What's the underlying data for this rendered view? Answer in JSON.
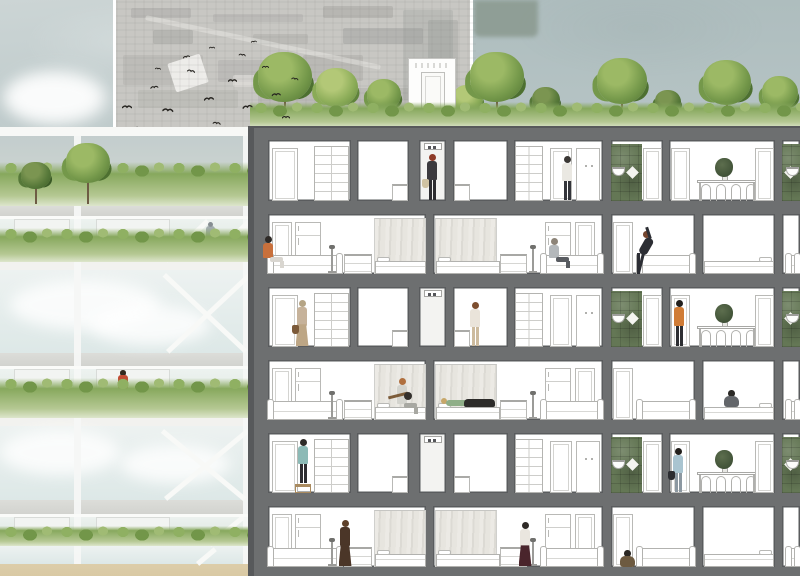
{
  "meta": {
    "type": "architectural-section-collage",
    "description": "Watercolor architectural cross-section of an apartment block with rooftop trees, aerial photo inset with bird flock, and glazed green-balcony facade at left"
  },
  "palette": {
    "sky_light": "#ccd5d5",
    "sky_base": "#b6c4c5",
    "sky_right": "#aebdbe",
    "sky_patch": "#8a998f",
    "photo_bg": "#c8c7c3",
    "photo_mark": "#8d8d8a",
    "bird": "#262420",
    "frame": "#6d6f70",
    "frame_edge": "#57595b",
    "room": "#ffffff",
    "room_line": "#5a5c5e",
    "shaft": "#f3f3f1",
    "furniture_line": "#b9b9b6",
    "tile_green": "#647755",
    "curtain": "#e7e5e0",
    "grass": "#87a85d",
    "grass_light": "#b5c893",
    "tree_light": "#8aab57",
    "tree_mid": "#74984a",
    "tree_dark": "#567839",
    "trunk": "#6e5c44",
    "glass": "#e7efee",
    "cloud": "#ffffff",
    "mullion": "#f6f7f5",
    "slab_white": "#f7f8f6",
    "slab_grey": "#d2d3cf",
    "spandrel": "#f2f2ef",
    "ground_tan": "#d9c9a4"
  },
  "sky": {
    "patch": {
      "x": 474,
      "y": 0,
      "w": 64,
      "h": 37
    }
  },
  "photo": {
    "x": 113,
    "y": 0,
    "w": 360,
    "h": 129,
    "marks": [
      {
        "x": 128,
        "y": 8,
        "w": 60,
        "h": 10,
        "o": 0.25
      },
      {
        "x": 210,
        "y": 14,
        "w": 90,
        "h": 8,
        "o": 0.2
      },
      {
        "x": 320,
        "y": 6,
        "w": 70,
        "h": 12,
        "o": 0.28
      },
      {
        "x": 150,
        "y": 30,
        "w": 40,
        "h": 14,
        "o": 0.3
      },
      {
        "x": 250,
        "y": 34,
        "w": 55,
        "h": 10,
        "o": 0.22
      },
      {
        "x": 340,
        "y": 28,
        "w": 80,
        "h": 16,
        "o": 0.35,
        "c": "#8f938f"
      },
      {
        "x": 400,
        "y": 10,
        "w": 50,
        "h": 90,
        "o": 0.3,
        "c": "#9aa09c"
      },
      {
        "x": 425,
        "y": 20,
        "w": 30,
        "h": 100,
        "o": 0.25,
        "c": "#878d89"
      },
      {
        "x": 120,
        "y": 55,
        "w": 80,
        "h": 30,
        "o": 0.18
      },
      {
        "x": 215,
        "y": 60,
        "w": 70,
        "h": 22,
        "o": 0.2
      },
      {
        "x": 300,
        "y": 55,
        "w": 60,
        "h": 26,
        "o": 0.24
      },
      {
        "x": 135,
        "y": 90,
        "w": 100,
        "h": 18,
        "o": 0.16
      },
      {
        "x": 255,
        "y": 92,
        "w": 80,
        "h": 16,
        "o": 0.2
      },
      {
        "x": 350,
        "y": 88,
        "w": 70,
        "h": 20,
        "o": 0.22
      },
      {
        "x": 140,
        "y": 40,
        "w": 240,
        "h": 5,
        "o": 0.5,
        "c": "#e8e7e3",
        "r": 12
      },
      {
        "x": 168,
        "y": 58,
        "w": 34,
        "h": 30,
        "o": 0.9,
        "c": "#f2f1ee",
        "r": -18
      },
      {
        "x": 230,
        "y": 75,
        "w": 26,
        "h": 12,
        "o": 0.5,
        "c": "#eceae6"
      }
    ]
  },
  "birds": [
    [
      122,
      96,
      10,
      0
    ],
    [
      136,
      118,
      9,
      10
    ],
    [
      149,
      76,
      8,
      -8
    ],
    [
      163,
      100,
      11,
      5
    ],
    [
      176,
      124,
      9,
      0
    ],
    [
      189,
      60,
      8,
      12
    ],
    [
      203,
      88,
      10,
      -6
    ],
    [
      214,
      112,
      8,
      8
    ],
    [
      228,
      70,
      9,
      0
    ],
    [
      241,
      96,
      10,
      -10
    ],
    [
      254,
      120,
      8,
      6
    ],
    [
      262,
      56,
      7,
      0
    ],
    [
      271,
      84,
      9,
      -5
    ],
    [
      240,
      44,
      7,
      8
    ],
    [
      209,
      36,
      6,
      0
    ],
    [
      181,
      46,
      7,
      -12
    ],
    [
      156,
      57,
      6,
      6
    ],
    [
      282,
      106,
      8,
      0
    ],
    [
      293,
      68,
      7,
      10
    ],
    [
      250,
      30,
      6,
      -5
    ]
  ],
  "roof": {
    "grass": {
      "x": 250,
      "y": 100,
      "w": 550,
      "h": 28
    },
    "trees": [
      {
        "cx": 285,
        "r": 27,
        "tone": "mid"
      },
      {
        "cx": 337,
        "r": 21,
        "tone": "light"
      },
      {
        "cx": 384,
        "r": 17,
        "tone": "mid"
      },
      {
        "cx": 468,
        "r": 15,
        "tone": "light"
      },
      {
        "cx": 497,
        "r": 27,
        "tone": "mid"
      },
      {
        "cx": 546,
        "r": 14,
        "tone": "dark"
      },
      {
        "cx": 622,
        "r": 25,
        "tone": "mid"
      },
      {
        "cx": 668,
        "r": 13,
        "tone": "dark"
      },
      {
        "cx": 727,
        "r": 24,
        "tone": "mid"
      },
      {
        "cx": 780,
        "r": 18,
        "tone": "mid"
      }
    ],
    "penthouse": {
      "x": 408,
      "y": 58,
      "w": 48,
      "h": 69,
      "door": {
        "x": 12,
        "y": 13,
        "w": 24,
        "h": 55
      }
    }
  },
  "section": {
    "base": {
      "x": 248,
      "y": 126,
      "w": 552,
      "h": 450
    },
    "floors": [
      {
        "layout": "odd",
        "top": 140,
        "bottom": 201
      },
      {
        "layout": "even",
        "top": 214,
        "bottom": 274
      },
      {
        "layout": "odd",
        "top": 287,
        "bottom": 347
      },
      {
        "layout": "even",
        "top": 360,
        "bottom": 420
      },
      {
        "layout": "odd",
        "top": 433,
        "bottom": 493
      },
      {
        "layout": "even",
        "top": 506,
        "bottom": 567
      }
    ],
    "layouts": {
      "odd": {
        "shaft": 2,
        "rooms": [
          [
            268,
            351
          ],
          [
            357,
            409
          ],
          [
            419,
            446
          ],
          [
            453,
            508
          ],
          [
            514,
            603
          ],
          [
            611,
            663
          ],
          [
            669,
            775
          ],
          [
            782,
            800
          ]
        ],
        "items": [
          {
            "t": "door",
            "x": 272,
            "w": 26
          },
          {
            "t": "wardrobe",
            "x": 314,
            "w": 35
          },
          {
            "t": "counter2",
            "x": 392,
            "w": 16
          },
          {
            "t": "indicator",
            "x": 424,
            "w": 18
          },
          {
            "t": "counter2",
            "x": 454,
            "w": 16
          },
          {
            "t": "wardrobe",
            "x": 515,
            "w": 28
          },
          {
            "t": "door",
            "x": 550,
            "w": 22
          },
          {
            "t": "cabinet",
            "x": 576,
            "w": 24
          },
          {
            "t": "tile",
            "x": 611,
            "w": 31
          },
          {
            "t": "sink",
            "x": 611,
            "w": 16,
            "side": "l"
          },
          {
            "t": "door",
            "x": 643,
            "w": 19
          },
          {
            "t": "door",
            "x": 671,
            "w": 19
          },
          {
            "t": "table",
            "x": 697,
            "w": 60
          },
          {
            "t": "plant",
            "x": 717,
            "w": 15
          },
          {
            "t": "door",
            "x": 755,
            "w": 19
          },
          {
            "t": "tile",
            "x": 782,
            "w": 18
          },
          {
            "t": "sink",
            "x": 786,
            "w": 14,
            "side": "r"
          }
        ]
      },
      "even": {
        "rooms": [
          [
            268,
            426
          ],
          [
            433,
            603
          ],
          [
            611,
            695
          ],
          [
            702,
            775
          ],
          [
            782,
            800
          ]
        ],
        "items": [
          {
            "t": "door",
            "x": 272,
            "w": 20
          },
          {
            "t": "fridge",
            "x": 295,
            "w": 26
          },
          {
            "t": "sofa",
            "x": 268,
            "w": 74
          },
          {
            "t": "lamp",
            "x": 331
          },
          {
            "t": "counter",
            "x": 344,
            "w": 28
          },
          {
            "t": "curtain",
            "x": 374,
            "w": 52
          },
          {
            "t": "bed",
            "x": 375,
            "w": 51,
            "pil": "l"
          },
          {
            "t": "curtain",
            "x": 435,
            "w": 62
          },
          {
            "t": "bed",
            "x": 436,
            "w": 64,
            "pil": "l"
          },
          {
            "t": "counter",
            "x": 500,
            "w": 27
          },
          {
            "t": "lamp",
            "x": 532
          },
          {
            "t": "fridge",
            "x": 545,
            "w": 26
          },
          {
            "t": "door",
            "x": 575,
            "w": 20
          },
          {
            "t": "sofa",
            "x": 541,
            "w": 62
          },
          {
            "t": "door",
            "x": 613,
            "w": 20
          },
          {
            "t": "sofa",
            "x": 637,
            "w": 58
          },
          {
            "t": "bed",
            "x": 704,
            "w": 70,
            "pil": "r"
          },
          {
            "t": "sofa",
            "x": 786,
            "w": 14
          }
        ]
      }
    },
    "people": {
      "0": [
        {
          "pose": "stand",
          "x": 423,
          "h": 47,
          "hair": "#8e3b28",
          "top": "#3b3a3e",
          "bottom": "#2c2c30",
          "bag": "#cfc2a2"
        },
        {
          "pose": "stand",
          "x": 558,
          "h": 45,
          "hair": "#3b3835",
          "top": "#eae8e2",
          "bottom": "#34353b"
        }
      ],
      "1": [
        {
          "pose": "sit",
          "x": 262,
          "h": 32,
          "dy": -6,
          "hair": "#2e2a27",
          "top": "#c8703c",
          "bottom": "#d9d6d0"
        },
        {
          "pose": "sit",
          "x": 548,
          "h": 30,
          "dy": -6,
          "hair": "#8d8478",
          "top": "#b4b8bb",
          "bottom": "#595c61"
        },
        {
          "pose": "bend",
          "x": 630,
          "h": 46,
          "hair": "#74452f",
          "top": "#2c2e34",
          "bottom": "#2c2e34"
        }
      ],
      "2": [
        {
          "pose": "stand",
          "x": 293,
          "h": 47,
          "dress": true,
          "hair": "#b5a485",
          "top": "#c6b29a",
          "bottom": "#bda685",
          "bag": "#7c5a39"
        },
        {
          "pose": "stand",
          "x": 466,
          "h": 45,
          "hair": "#7d4e2f",
          "top": "#eae4da",
          "bottom": "#cdbb9e"
        },
        {
          "pose": "stand",
          "x": 670,
          "h": 47,
          "hair": "#221f1c",
          "top": "#d07c36",
          "bottom": "#2d2e32"
        }
      ],
      "3": [
        {
          "pose": "sit",
          "x": 396,
          "h": 36,
          "dy": -6,
          "hair": "#b06f3e",
          "top": "#d3d3cd",
          "bottom": "#a8a8a2",
          "prop": "guitar"
        },
        {
          "pose": "lie",
          "x": 441,
          "w": 54,
          "dy": -13,
          "hair": "#c7a769",
          "top": "#8fae88",
          "blanket": "#2d2c2a"
        },
        {
          "pose": "sitfloor",
          "x": 722,
          "dy": -13,
          "hair": "#2b2926",
          "top": "#63666a"
        }
      ],
      "4": [
        {
          "pose": "stand",
          "x": 294,
          "h": 45,
          "dy": -9,
          "hair": "#2e2b28",
          "top": "#8cbab6",
          "bottom": "#2d2d31",
          "prop": "stool"
        },
        {
          "pose": "stand",
          "x": 669,
          "h": 45,
          "hair": "#221f1c",
          "top": "#a9c4d0",
          "bottom": "#8c98a1",
          "bag": "#2b2c30"
        }
      ],
      "5": [
        {
          "pose": "stand",
          "x": 336,
          "h": 47,
          "dress": true,
          "hair": "#5d4029",
          "top": "#4b3628",
          "bottom": "#4b3628"
        },
        {
          "pose": "stand",
          "x": 516,
          "h": 45,
          "dress": true,
          "hair": "#2e2a27",
          "top": "#eae6df",
          "bottom": "#4a252c"
        },
        {
          "pose": "sitfloor",
          "x": 618,
          "hair": "#2b2824",
          "top": "#6d5a40"
        }
      ]
    }
  },
  "elevation": {
    "x": 0,
    "w": 250,
    "bands": [
      {
        "t": "slabW",
        "y": 127,
        "h": 9
      },
      {
        "t": "garden",
        "y": 136,
        "h": 70
      },
      {
        "t": "slabG",
        "y": 206,
        "h": 10
      },
      {
        "t": "hedgeLevel",
        "y": 216,
        "h": 46,
        "persons": [
          {
            "x": 206,
            "kind": "muted"
          }
        ]
      },
      {
        "t": "spandrel",
        "y": 262,
        "h": 8
      },
      {
        "t": "glass",
        "y": 270,
        "h": 83
      },
      {
        "t": "slabG",
        "y": 353,
        "h": 13
      },
      {
        "t": "hedgeLevel",
        "y": 366,
        "h": 52,
        "persons": [
          {
            "x": 118,
            "kind": "red"
          }
        ]
      },
      {
        "t": "spandrel",
        "y": 418,
        "h": 8
      },
      {
        "t": "glass",
        "y": 426,
        "h": 74
      },
      {
        "t": "slabG",
        "y": 500,
        "h": 14
      },
      {
        "t": "hedgeLevel",
        "y": 514,
        "h": 32
      },
      {
        "t": "glass",
        "y": 546,
        "h": 18
      },
      {
        "t": "ground",
        "y": 564,
        "h": 12
      }
    ],
    "mullions": [
      {
        "x": 74,
        "w": 7
      },
      {
        "x": 243,
        "w": 8
      }
    ],
    "braces": [
      [
        164,
        259,
        206,
        219
      ],
      [
        206,
        259,
        248,
        219
      ],
      [
        166,
        350,
        248,
        273
      ],
      [
        166,
        273,
        248,
        350
      ],
      [
        164,
        497,
        246,
        429
      ],
      [
        164,
        429,
        246,
        497
      ],
      [
        208,
        543,
        242,
        515
      ],
      [
        196,
        562,
        214,
        547
      ]
    ],
    "gardenTrees": [
      {
        "cx": 36,
        "r": 15,
        "tone": "dark"
      },
      {
        "cx": 88,
        "r": 22,
        "tone": "mid"
      }
    ],
    "clouds": [
      {
        "x": 10,
        "y": 280,
        "w": 150,
        "h": 50
      },
      {
        "x": 90,
        "y": 305,
        "w": 120,
        "h": 40
      },
      {
        "x": 0,
        "y": 430,
        "w": 120,
        "h": 45
      },
      {
        "x": 120,
        "y": 445,
        "w": 110,
        "h": 38
      },
      {
        "x": 5,
        "y": 75,
        "w": 95,
        "h": 45
      }
    ],
    "windows": [
      [
        14,
        70
      ],
      [
        96,
        170
      ]
    ]
  }
}
